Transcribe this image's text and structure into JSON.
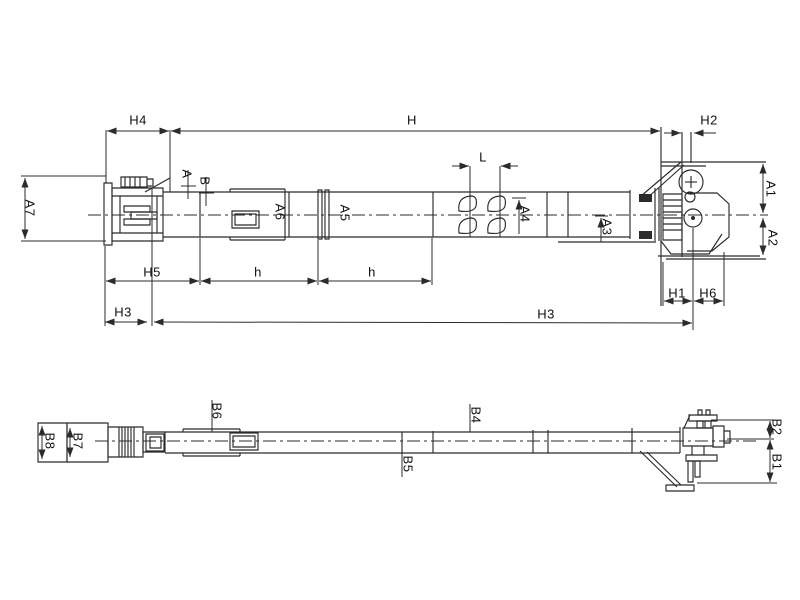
{
  "colors": {
    "background": "#ffffff",
    "line": "#2b2b2b",
    "text": "#111111"
  },
  "top_view": {
    "name": "side-elevation-view",
    "labels": {
      "h4": "H4",
      "h_overall": "H",
      "h2": "H2",
      "a7": "A7",
      "section_a": "A",
      "section_b": "B",
      "a6": "A6",
      "a5": "A5",
      "l": "L",
      "a4": "A4",
      "a3": "A3",
      "a1": "A1",
      "a2": "A2",
      "h5": "H5",
      "h_pitch_1": "h",
      "h_pitch_2": "h",
      "h1": "H1",
      "h6": "H6",
      "h3_left": "H3",
      "h3_overall": "H3"
    }
  },
  "bottom_view": {
    "name": "plan-view",
    "labels": {
      "b8": "B8",
      "b7": "B7",
      "b6": "B6",
      "b5": "B5",
      "b4": "B4",
      "b2": "B2",
      "b1": "B1"
    }
  }
}
